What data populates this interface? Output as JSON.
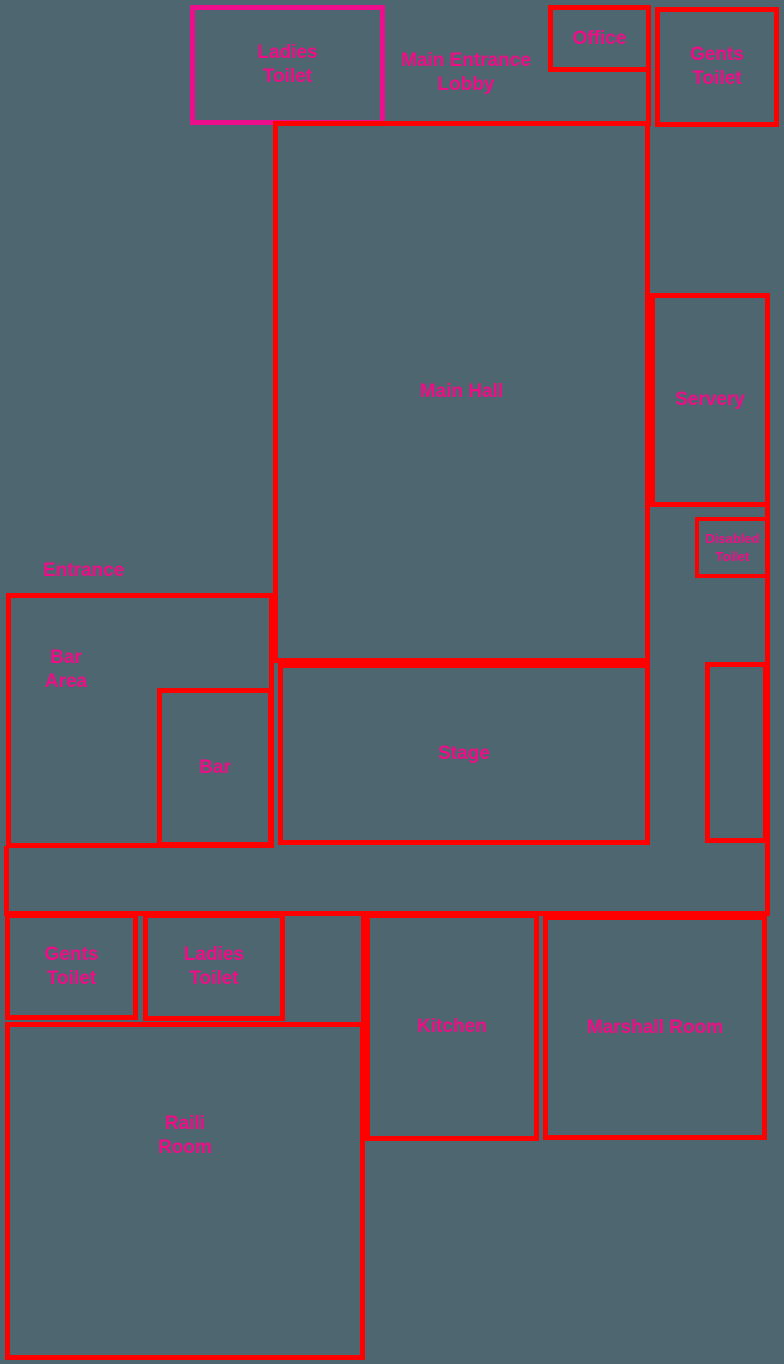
{
  "colors": {
    "background": "#4e6670",
    "wall_red": "#ff0000",
    "ladies_toilet_outline_magenta": "#ec0e8c",
    "label_pink": "#ee0d86"
  },
  "rooms": {
    "ladies_toilet_top": {
      "line1": "Ladies",
      "line2": "Toilet"
    },
    "main_entrance_lobby": {
      "line1": "Main Entrance",
      "line2": "Lobby"
    },
    "office": {
      "label": "Office"
    },
    "gents_toilet_top": {
      "line1": "Gents",
      "line2": "Toilet"
    },
    "main_hall": {
      "label": "Main Hall"
    },
    "servery": {
      "label": "Servery"
    },
    "disabled_toilet": {
      "line1": "Disabled",
      "line2": "Toilet"
    },
    "entrance": {
      "label": "Entrance"
    },
    "bar_area": {
      "line1": "Bar",
      "line2": "Area"
    },
    "bar": {
      "label": "Bar"
    },
    "stage": {
      "label": "Stage"
    },
    "gents_toilet_bottom": {
      "line1": "Gents",
      "line2": "Toilet"
    },
    "ladies_toilet_bottom": {
      "line1": "Ladies",
      "line2": "Toilet"
    },
    "kitchen": {
      "label": "Kitchen"
    },
    "marshall_room": {
      "label": "Marshall Room"
    },
    "raili_room": {
      "line1": "Raili",
      "line2": "Room"
    }
  }
}
